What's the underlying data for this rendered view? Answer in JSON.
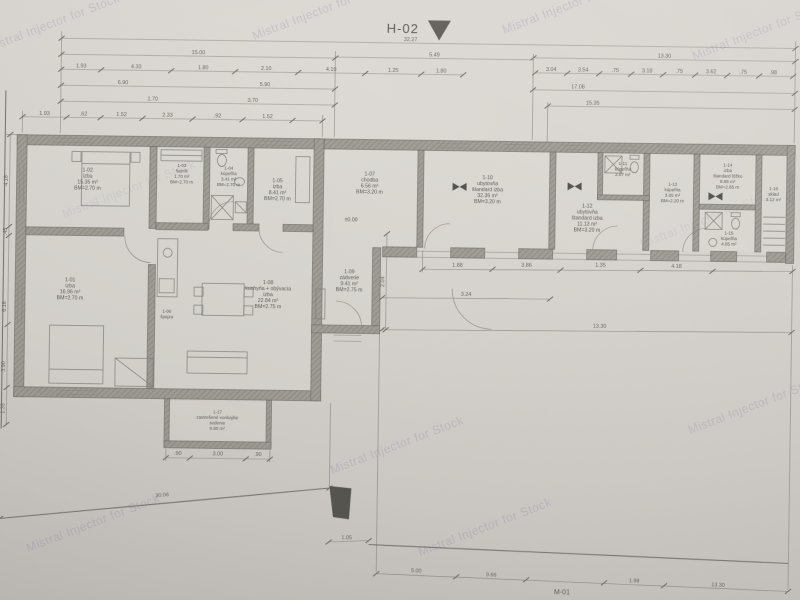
{
  "marks": {
    "h02": "H-02",
    "m01": "M-01",
    "zero": "±0.00"
  },
  "watermark": {
    "text": "Mistral Injector for Stock"
  },
  "rooms": [
    {
      "code": "1-01",
      "n1": "izba",
      "area": "16.96 m²",
      "h": "BM=2.70 m"
    },
    {
      "code": "1-02",
      "n1": "izba",
      "area": "15.35 m²",
      "h": "BM=2.70 m"
    },
    {
      "code": "1-03",
      "n1": "šatník",
      "area": "1.70 m²",
      "h": "BM=2.70 m"
    },
    {
      "code": "1-04",
      "n1": "kúpeľňa",
      "area": "3.41 m²",
      "h": "BM=2.70 m"
    },
    {
      "code": "1-05",
      "n1": "izba",
      "area": "8.41 m²",
      "h": "BM=2.70 m"
    },
    {
      "code": "1-06",
      "n1": "špajza",
      "area": "0.91 m²"
    },
    {
      "code": "1-07",
      "n1": "chodba",
      "area": "6.56 m²",
      "h": "BM=3.20 m"
    },
    {
      "code": "1-08",
      "n1": "kuchyňa + obývacia",
      "n2": "izba",
      "area": "22.84 m²",
      "h": "BM=2.75 m"
    },
    {
      "code": "1-09",
      "n1": "zádverie",
      "area": "9.41 m²",
      "h": "BM=2.75 m"
    },
    {
      "code": "1-10",
      "n1": "ubytovňa",
      "n2": "štandard izba",
      "area": "32.36 m²",
      "h": "BM=3.20 m"
    },
    {
      "code": "1-11",
      "n1": "kúpeľňa",
      "area": "2.87 m²"
    },
    {
      "code": "1-12",
      "n1": "ubytovňa",
      "n2": "štandard izba",
      "area": "11.13 m²",
      "h": "BM=3.20 m"
    },
    {
      "code": "1-13",
      "n1": "kúpeľňa",
      "area": "3.05 m²",
      "h": "BM=2.20 m"
    },
    {
      "code": "1-14",
      "n1": "izba",
      "n2": "štandard lôžko",
      "area": "8.85 m²",
      "h": "BM=2.85 m"
    },
    {
      "code": "1-15",
      "n1": "kúpeľňa",
      "area": "4.85 m²"
    },
    {
      "code": "1-16",
      "n1": "sklad",
      "area": "3.12 m²"
    },
    {
      "code": "1-17",
      "n1": "zastrešené vonkajšie",
      "n2": "sedenie",
      "area": "9.50 m²"
    }
  ],
  "dims": {
    "overall": "32.27",
    "t1": [
      "15.00",
      "5.49",
      "13.30"
    ],
    "t2": [
      "1.93",
      "4.33",
      "1.80",
      "2.10",
      "4.10",
      "1.25",
      "1.80"
    ],
    "t2r": [
      "3.04",
      "3.54",
      ".75",
      "3.18",
      ".75",
      "3.62",
      ".75",
      ".98"
    ],
    "t3": [
      "6.90",
      "5.90",
      "17.08"
    ],
    "t4": [
      "1.70",
      "3.70",
      "15.35"
    ],
    "t5": [
      "1.93",
      ".62",
      "1.52",
      "2.33",
      ".92",
      "1.52"
    ],
    "lv": [
      "4.18",
      ".45",
      "6.16",
      "3.90",
      "1.35"
    ],
    "m1": [
      "1.88",
      "3.86",
      "1.35",
      "4.18"
    ],
    "m2": [
      "3.24",
      "13.30"
    ],
    "tr": [
      ".90",
      "3.00",
      ".90"
    ],
    "b1": [
      "30.06",
      "1.05"
    ],
    "b2": [
      "5.00",
      "9.66",
      "1.98",
      "13.30"
    ],
    "v2": "2.04"
  }
}
